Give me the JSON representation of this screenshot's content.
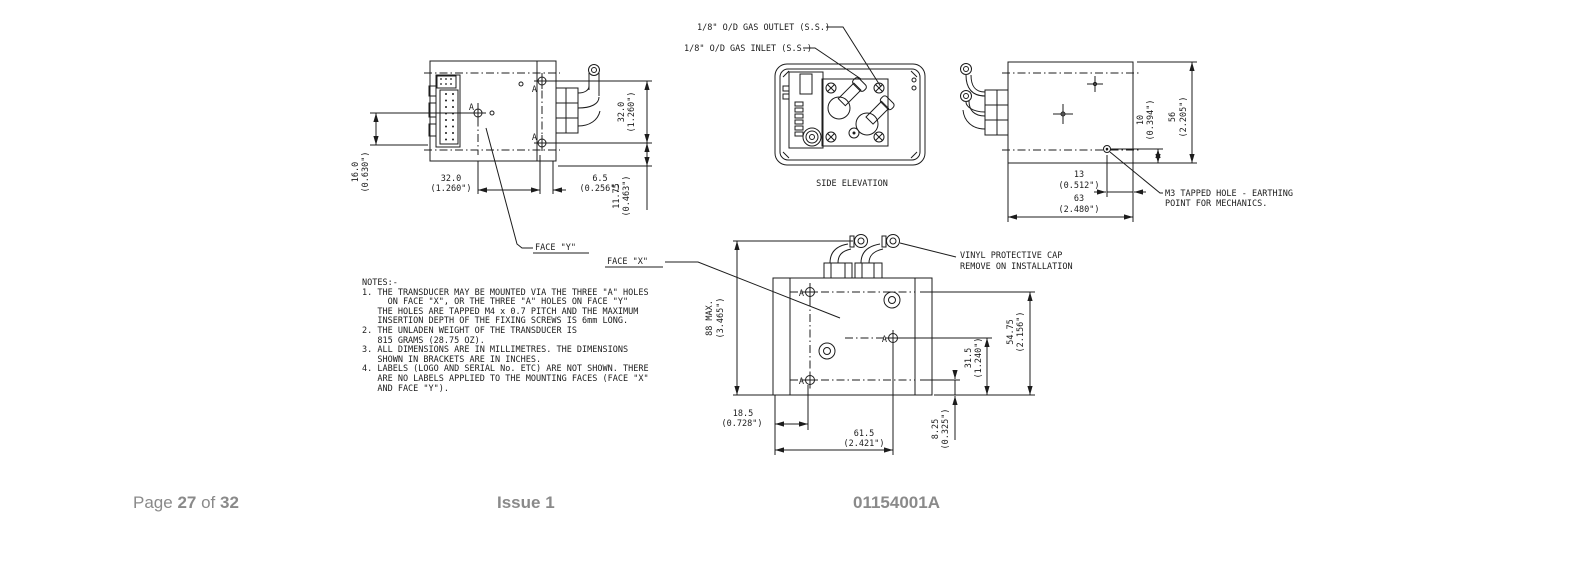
{
  "colors": {
    "line": "#1c1c1c",
    "footer_text": "#8a8a8a",
    "background": "#ffffff"
  },
  "callouts": {
    "gas_outlet": "1/8\" O/D GAS OUTLET (S.S.)",
    "gas_inlet": "1/8\" O/D GAS INLET (S.S.)",
    "side_elevation": "SIDE ELEVATION",
    "face_y": "FACE \"Y\"",
    "face_x": "FACE \"X\"",
    "m3_line1": "M3 TAPPED HOLE - EARTHING",
    "m3_line2": "POINT FOR MECHANICS.",
    "vinyl_line1": "VINYL PROTECTIVE CAP",
    "vinyl_line2": "REMOVE ON INSTALLATION",
    "hole_label": "A"
  },
  "view_left": {
    "dim_16_mm": "16.0",
    "dim_16_in": "(0.630\")",
    "dim_32b_mm": "32.0",
    "dim_32b_in": "(1.260\")",
    "dim_65_mm": "6.5",
    "dim_65_in": "(0.256\")",
    "dim_32r_mm": "32.0",
    "dim_32r_in": "(1.260\")",
    "dim_1175_mm": "11.75",
    "dim_1175_in": "(0.463\")"
  },
  "view_right": {
    "dim_10_mm": "10",
    "dim_10_in": "(0.394\")",
    "dim_56_mm": "56",
    "dim_56_in": "(2.205\")",
    "dim_13_mm": "13",
    "dim_13_in": "(0.512\")",
    "dim_63_mm": "63",
    "dim_63_in": "(2.480\")"
  },
  "view_bottom": {
    "dim_88_mm": "88 MAX.",
    "dim_88_in": "(3.465\")",
    "dim_185_mm": "18.5",
    "dim_185_in": "(0.728\")",
    "dim_615_mm": "61.5",
    "dim_615_in": "(2.421\")",
    "dim_825_mm": "8.25",
    "dim_825_in": "(0.325\")",
    "dim_315_mm": "31.5",
    "dim_315_in": "(1.240\")",
    "dim_5475_mm": "54.75",
    "dim_5475_in": "(2.156\")"
  },
  "notes": {
    "lines": [
      "NOTES:-",
      "1. THE TRANSDUCER MAY BE MOUNTED VIA THE THREE \"A\" HOLES",
      "     ON FACE \"X\", OR THE THREE \"A\" HOLES ON FACE \"Y\"",
      "   THE HOLES ARE TAPPED M4 x 0.7 PITCH AND THE MAXIMUM",
      "   INSERTION DEPTH OF THE FIXING SCREWS IS 6mm LONG.",
      "2. THE UNLADEN WEIGHT OF THE TRANSDUCER IS",
      "   815 GRAMS (28.75 OZ).",
      "3. ALL DIMENSIONS ARE IN MILLIMETRES. THE DIMENSIONS",
      "   SHOWN IN BRACKETS ARE IN INCHES.",
      "4. LABELS (LOGO AND SERIAL No. ETC) ARE NOT SHOWN. THERE",
      "   ARE NO LABELS APPLIED TO THE MOUNTING FACES (FACE \"X\"",
      "   AND FACE \"Y\")."
    ]
  },
  "footer": {
    "page_label": "Page",
    "page_current": "27",
    "of_label": "of",
    "page_total": "32",
    "issue": "Issue 1",
    "doc_number": "01154001A"
  }
}
